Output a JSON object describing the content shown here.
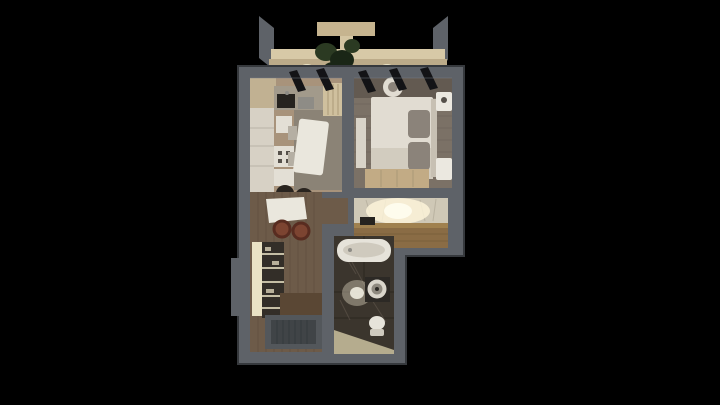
{
  "viewer": {
    "background": "#000000",
    "subject": "apartment-floorplan-3d-render",
    "rooms": [
      "balcony",
      "kitchen-living-room",
      "bedroom",
      "entry-hall",
      "corridor",
      "bathroom"
    ]
  },
  "colors": {
    "background": "#000000",
    "wall": "#5e6268",
    "wall_edge": "#36393d",
    "wall_light": "#7b8187",
    "canopy": "#c6b48f",
    "canopy_light": "#d4c5a2",
    "balcony_top": "#d7c9a7",
    "balcony_face": "#bcab89",
    "sconce_glow": "#e8dfc2",
    "plant": "#2b3a22",
    "plant_dark": "#1a2616",
    "window_frame": "#131316",
    "kitchen_floor": "#a8937b",
    "kitchen_wall": "#c1b192",
    "kitchen_rug": "#8b8376",
    "counter": "#a29a8b",
    "counter_white": "#d7d1c5",
    "seam": "#b9b3a7",
    "sink": "#26231f",
    "steel": "#8e8c86",
    "cabinet_beige": "#cfc09e",
    "cabinet_stripe": "#ab9a78",
    "appliance_white": "#e3dfd5",
    "burner": "#55504a",
    "table_white": "#eae7dd",
    "chair_gray": "#b5afa3",
    "chair_dark": "#29241f",
    "bedroom_floor": "#7b7166",
    "bedroom_floor_dark": "#635a51",
    "plank_line": "#6b6257",
    "bed": "#e1dcd2",
    "bed_fold": "#d2ccbf",
    "pillow": "#8b837a",
    "headboard": "#c7c0b3",
    "nightstand": "#ebe8e0",
    "mirror": "#d8d3c8",
    "wardrobe": "#c2ab85",
    "marble": "#cfc8b6",
    "vein": "#a59d8b",
    "glow": "#fff6dc",
    "glow_core": "#fffdf0",
    "hall_wood": "#8a6c45",
    "hall_wood_light": "#a0814f",
    "hall_wood_seam": "#6f5636",
    "corridor_floor": "#6d5b49",
    "corridor_plank": "#5a4a3b",
    "shelf_cream": "#eae2c4",
    "shelf_dark": "#332e28",
    "shelf_item": "#b8b09a",
    "stool": "#7c4431",
    "stool_dark": "#582c20",
    "door": "#5a4734",
    "mat": "#53575b",
    "mat_inner": "#404447",
    "mat_rib": "#343a3d",
    "bath_floor": "#3b352d",
    "bath_seam": "#2b2620",
    "bath_vein": "#6e6458",
    "bath_mat": "#b5ac8e",
    "tub": "#e6e3da",
    "tub_inner": "#cfcabe",
    "washer": "#2c2925",
    "washer_ring": "#d9d5cb",
    "washer_door": "#8e897f"
  }
}
